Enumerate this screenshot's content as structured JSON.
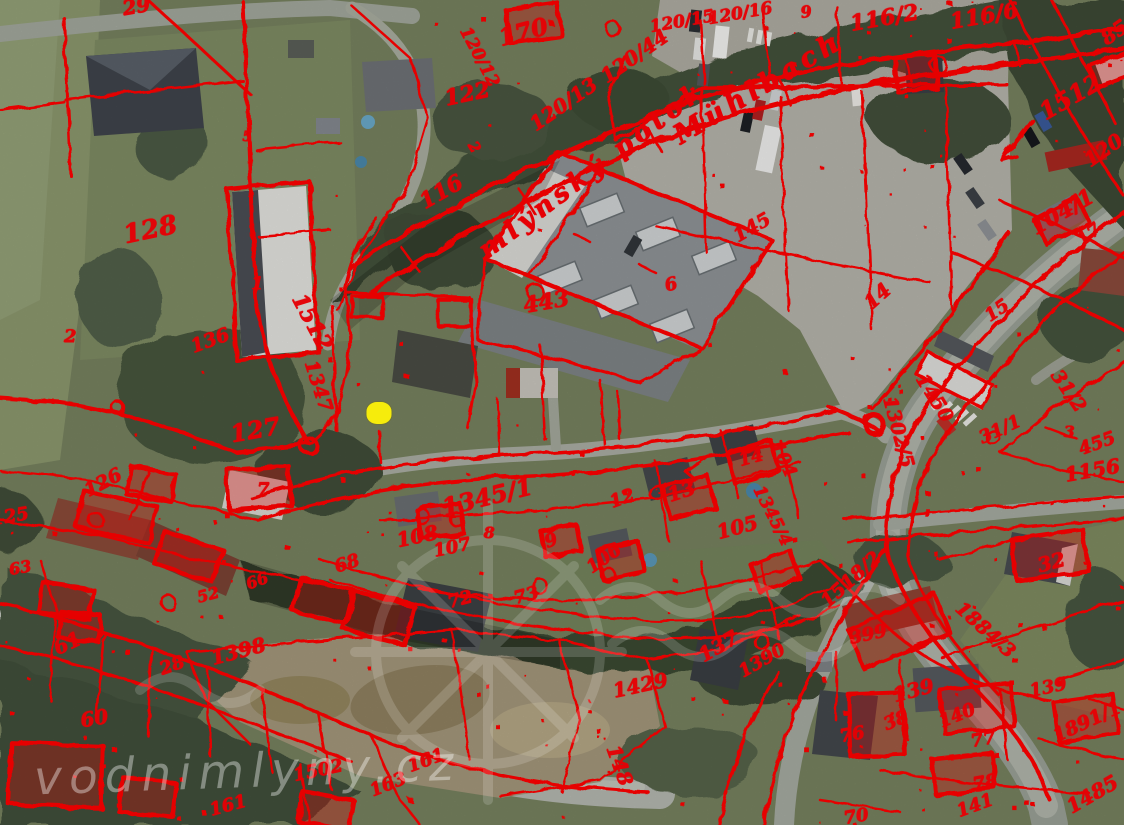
{
  "page": {
    "width": 1124,
    "height": 825
  },
  "map": {
    "description": "aerial orthophoto with red cadastral parcel overlay",
    "overlay_color": "#e60005",
    "marker": {
      "label": "selected-point",
      "x": 379,
      "y": 413,
      "color": "#f6ec0c"
    },
    "watermark": {
      "text": "vodnimlyny.cz",
      "logo": "water-mill-wheel",
      "color": "#ffffff"
    },
    "stream_labels": [
      {
        "text": "mlýnský potok",
        "x": 592,
        "y": 170,
        "r": -37,
        "s": 26
      },
      {
        "text": "Mühlbach",
        "x": 758,
        "y": 88,
        "r": -31,
        "s": 27
      }
    ],
    "parcel_labels": [
      {
        "text": "29",
        "x": 136,
        "y": 6,
        "r": -10,
        "s": 20
      },
      {
        "text": "170",
        "x": 523,
        "y": 32,
        "r": -15,
        "s": 24
      },
      {
        "text": "120/12",
        "x": 479,
        "y": 57,
        "r": 62,
        "s": 17
      },
      {
        "text": "122",
        "x": 467,
        "y": 94,
        "r": -12,
        "s": 22
      },
      {
        "text": "120/13",
        "x": 563,
        "y": 104,
        "r": -35,
        "s": 20
      },
      {
        "text": "120/44",
        "x": 634,
        "y": 56,
        "r": -35,
        "s": 20
      },
      {
        "text": "120/15",
        "x": 682,
        "y": 22,
        "r": -10,
        "s": 17
      },
      {
        "text": "120/16",
        "x": 740,
        "y": 14,
        "r": -10,
        "s": 17
      },
      {
        "text": "9",
        "x": 806,
        "y": 12,
        "r": -8,
        "s": 16
      },
      {
        "text": "116/2",
        "x": 884,
        "y": 18,
        "r": -10,
        "s": 22
      },
      {
        "text": "116/6",
        "x": 984,
        "y": 16,
        "r": -10,
        "s": 22
      },
      {
        "text": "85",
        "x": 1114,
        "y": 32,
        "r": -35,
        "s": 20
      },
      {
        "text": "1512",
        "x": 1070,
        "y": 97,
        "r": -30,
        "s": 24
      },
      {
        "text": "120",
        "x": 1103,
        "y": 150,
        "r": -35,
        "s": 20
      },
      {
        "text": "5",
        "x": 247,
        "y": 137,
        "r": 0,
        "s": 14
      },
      {
        "text": "2",
        "x": 474,
        "y": 147,
        "r": 60,
        "s": 15
      },
      {
        "text": "116",
        "x": 441,
        "y": 192,
        "r": -30,
        "s": 22
      },
      {
        "text": "128",
        "x": 150,
        "y": 230,
        "r": -12,
        "s": 26
      },
      {
        "text": "1",
        "x": 257,
        "y": 284,
        "r": 0,
        "s": 18
      },
      {
        "text": "136",
        "x": 210,
        "y": 341,
        "r": -20,
        "s": 19
      },
      {
        "text": "2",
        "x": 70,
        "y": 337,
        "r": 0,
        "s": 18
      },
      {
        "text": "1512",
        "x": 312,
        "y": 322,
        "r": 62,
        "s": 22
      },
      {
        "text": "1347",
        "x": 318,
        "y": 386,
        "r": 72,
        "s": 19
      },
      {
        "text": "443",
        "x": 546,
        "y": 302,
        "r": -10,
        "s": 22
      },
      {
        "text": "6",
        "x": 671,
        "y": 285,
        "r": -15,
        "s": 18
      },
      {
        "text": "145",
        "x": 752,
        "y": 228,
        "r": -30,
        "s": 19
      },
      {
        "text": "14",
        "x": 877,
        "y": 296,
        "r": -42,
        "s": 20
      },
      {
        "text": "104/1",
        "x": 1062,
        "y": 212,
        "r": -30,
        "s": 22
      },
      {
        "text": "17",
        "x": 1089,
        "y": 235,
        "r": -38,
        "s": 18
      },
      {
        "text": "15",
        "x": 997,
        "y": 311,
        "r": -35,
        "s": 18
      },
      {
        "text": "1450",
        "x": 934,
        "y": 398,
        "r": 58,
        "s": 19
      },
      {
        "text": "1302/5",
        "x": 898,
        "y": 432,
        "r": 75,
        "s": 19
      },
      {
        "text": "31/2",
        "x": 1068,
        "y": 391,
        "r": 55,
        "s": 19
      },
      {
        "text": "31/1",
        "x": 1000,
        "y": 430,
        "r": -25,
        "s": 18
      },
      {
        "text": "3",
        "x": 1069,
        "y": 432,
        "r": 0,
        "s": 16
      },
      {
        "text": "455",
        "x": 1097,
        "y": 444,
        "r": -20,
        "s": 18
      },
      {
        "text": "1156",
        "x": 1092,
        "y": 470,
        "r": -10,
        "s": 20
      },
      {
        "text": "127",
        "x": 255,
        "y": 430,
        "r": -10,
        "s": 24
      },
      {
        "text": "126",
        "x": 103,
        "y": 483,
        "r": -28,
        "s": 19
      },
      {
        "text": "7",
        "x": 263,
        "y": 490,
        "r": 0,
        "s": 18
      },
      {
        "text": "125",
        "x": 10,
        "y": 517,
        "r": -10,
        "s": 18
      },
      {
        "text": "63",
        "x": 20,
        "y": 568,
        "r": -10,
        "s": 16
      },
      {
        "text": "52",
        "x": 208,
        "y": 595,
        "r": -15,
        "s": 16
      },
      {
        "text": "66",
        "x": 257,
        "y": 581,
        "r": -20,
        "s": 16
      },
      {
        "text": "68",
        "x": 347,
        "y": 564,
        "r": -18,
        "s": 18
      },
      {
        "text": "108",
        "x": 417,
        "y": 536,
        "r": -12,
        "s": 20
      },
      {
        "text": "107",
        "x": 452,
        "y": 548,
        "r": -12,
        "s": 18
      },
      {
        "text": "8",
        "x": 489,
        "y": 533,
        "r": 0,
        "s": 16
      },
      {
        "text": "9",
        "x": 551,
        "y": 541,
        "r": -20,
        "s": 18
      },
      {
        "text": "1345/1",
        "x": 487,
        "y": 497,
        "r": -14,
        "s": 24
      },
      {
        "text": "12",
        "x": 622,
        "y": 499,
        "r": -20,
        "s": 18
      },
      {
        "text": "106",
        "x": 604,
        "y": 559,
        "r": -35,
        "s": 18
      },
      {
        "text": "13",
        "x": 681,
        "y": 491,
        "r": -18,
        "s": 20
      },
      {
        "text": "14",
        "x": 751,
        "y": 458,
        "r": -15,
        "s": 18
      },
      {
        "text": "104",
        "x": 783,
        "y": 459,
        "r": 65,
        "s": 18
      },
      {
        "text": "1345/4",
        "x": 772,
        "y": 516,
        "r": 63,
        "s": 17
      },
      {
        "text": "105",
        "x": 737,
        "y": 527,
        "r": -15,
        "s": 20
      },
      {
        "text": "61",
        "x": 67,
        "y": 643,
        "r": -25,
        "s": 20
      },
      {
        "text": "28",
        "x": 172,
        "y": 666,
        "r": -20,
        "s": 18
      },
      {
        "text": "1398",
        "x": 238,
        "y": 651,
        "r": -15,
        "s": 20
      },
      {
        "text": "60",
        "x": 94,
        "y": 718,
        "r": -10,
        "s": 20
      },
      {
        "text": "161",
        "x": 228,
        "y": 806,
        "r": -15,
        "s": 18
      },
      {
        "text": "1502",
        "x": 318,
        "y": 771,
        "r": -12,
        "s": 18
      },
      {
        "text": "163",
        "x": 388,
        "y": 785,
        "r": -22,
        "s": 18
      },
      {
        "text": "161",
        "x": 426,
        "y": 761,
        "r": -20,
        "s": 18
      },
      {
        "text": "72",
        "x": 460,
        "y": 600,
        "r": -15,
        "s": 18
      },
      {
        "text": "73",
        "x": 526,
        "y": 596,
        "r": -15,
        "s": 18
      },
      {
        "text": "1429",
        "x": 640,
        "y": 685,
        "r": -12,
        "s": 20
      },
      {
        "text": "148",
        "x": 620,
        "y": 765,
        "r": 70,
        "s": 20
      },
      {
        "text": "137",
        "x": 718,
        "y": 646,
        "r": -30,
        "s": 20
      },
      {
        "text": "1390",
        "x": 762,
        "y": 661,
        "r": -30,
        "s": 18
      },
      {
        "text": "1518/2",
        "x": 851,
        "y": 580,
        "r": -42,
        "s": 19
      },
      {
        "text": "399",
        "x": 868,
        "y": 635,
        "r": -12,
        "s": 18
      },
      {
        "text": "32",
        "x": 1051,
        "y": 562,
        "r": -15,
        "s": 20
      },
      {
        "text": "1884/3",
        "x": 985,
        "y": 630,
        "r": 42,
        "s": 19
      },
      {
        "text": "139",
        "x": 913,
        "y": 690,
        "r": -15,
        "s": 20
      },
      {
        "text": "139",
        "x": 1048,
        "y": 688,
        "r": -12,
        "s": 18
      },
      {
        "text": "38",
        "x": 896,
        "y": 721,
        "r": -22,
        "s": 18
      },
      {
        "text": "140",
        "x": 957,
        "y": 716,
        "r": -22,
        "s": 18
      },
      {
        "text": "76",
        "x": 852,
        "y": 735,
        "r": -10,
        "s": 18
      },
      {
        "text": "77",
        "x": 983,
        "y": 740,
        "r": -10,
        "s": 18
      },
      {
        "text": "78",
        "x": 985,
        "y": 783,
        "r": -10,
        "s": 18
      },
      {
        "text": "141",
        "x": 975,
        "y": 806,
        "r": -20,
        "s": 18
      },
      {
        "text": "1891/1",
        "x": 1087,
        "y": 722,
        "r": -25,
        "s": 19
      },
      {
        "text": "1485",
        "x": 1092,
        "y": 794,
        "r": -30,
        "s": 20
      },
      {
        "text": "70",
        "x": 856,
        "y": 817,
        "r": -10,
        "s": 18
      }
    ]
  }
}
